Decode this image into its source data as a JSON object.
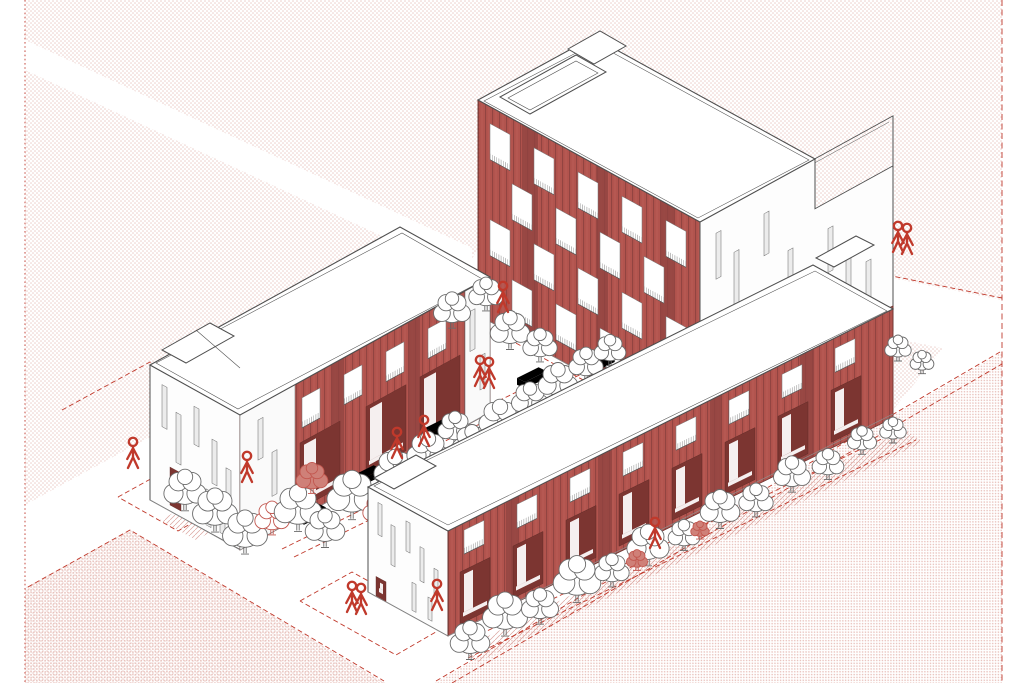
{
  "scene": {
    "kind": "architectural axonometric illustration",
    "subject": "three residential blocks with red facades around a linear tree-lined courtyard",
    "ground": "pink halftone dot fields with white diagonal streets and red dashed parcel lines"
  },
  "colors": {
    "facade": "#b2544e",
    "facade_dark": "#8f4340",
    "facade_shadow": "#7c3531",
    "line": "#4f4f4f",
    "red": "#c0392b",
    "red_soft": "#cf6a61",
    "dot": "#e9c9c4",
    "dot2": "#e6bcb6",
    "tree_line": "#6b6b6b",
    "tree_red": "#c2574f",
    "tree_fill": "#cf8078"
  },
  "buildings": [
    {
      "id": "tower",
      "name": "rear-tower-block",
      "stories": 4,
      "red_faces": 1
    },
    {
      "id": "left-bar",
      "name": "left-low-bar",
      "stories": 3,
      "red_faces": 1
    },
    {
      "id": "front-bar",
      "name": "front-long-bar",
      "stories": 2,
      "red_faces": 1
    }
  ],
  "faces": [
    {
      "target": "w-a-sw",
      "items": [
        {
          "x": 44,
          "y": -215,
          "w": 16,
          "h": 215,
          "k": "panel"
        },
        {
          "x": 118,
          "y": -215,
          "w": 12,
          "h": 215,
          "k": "panel"
        },
        {
          "x": 182,
          "y": -215,
          "w": 14,
          "h": 215,
          "k": "panel"
        },
        {
          "x": 12,
          "y": -198,
          "w": 20,
          "h": 36
        },
        {
          "x": 56,
          "y": -198,
          "w": 20,
          "h": 36
        },
        {
          "x": 100,
          "y": -198,
          "w": 20,
          "h": 36
        },
        {
          "x": 144,
          "y": -198,
          "w": 20,
          "h": 36
        },
        {
          "x": 188,
          "y": -198,
          "w": 20,
          "h": 36
        },
        {
          "x": 34,
          "y": -150,
          "w": 20,
          "h": 36
        },
        {
          "x": 78,
          "y": -150,
          "w": 20,
          "h": 36
        },
        {
          "x": 122,
          "y": -150,
          "w": 20,
          "h": 36
        },
        {
          "x": 166,
          "y": -150,
          "w": 20,
          "h": 36
        },
        {
          "x": 12,
          "y": -102,
          "w": 20,
          "h": 36
        },
        {
          "x": 56,
          "y": -102,
          "w": 20,
          "h": 36
        },
        {
          "x": 100,
          "y": -102,
          "w": 20,
          "h": 36
        },
        {
          "x": 144,
          "y": -102,
          "w": 20,
          "h": 36
        },
        {
          "x": 188,
          "y": -102,
          "w": 20,
          "h": 36
        },
        {
          "x": 34,
          "y": -54,
          "w": 20,
          "h": 36
        },
        {
          "x": 78,
          "y": -54,
          "w": 20,
          "h": 36
        },
        {
          "x": 122,
          "y": -54,
          "w": 20,
          "h": 36
        },
        {
          "x": 166,
          "y": -54,
          "w": 20,
          "h": 36
        }
      ]
    },
    {
      "target": "w-a-se",
      "items": [
        {
          "x": 16,
          "y": -195,
          "w": 5,
          "h": 46,
          "k": "slit"
        },
        {
          "x": 34,
          "y": -166,
          "w": 5,
          "h": 56,
          "k": "slit"
        },
        {
          "x": 64,
          "y": -188,
          "w": 5,
          "h": 42,
          "k": "slit"
        },
        {
          "x": 88,
          "y": -138,
          "w": 5,
          "h": 52,
          "k": "slit"
        },
        {
          "x": 26,
          "y": -94,
          "w": 5,
          "h": 44,
          "k": "slit"
        },
        {
          "x": 56,
          "y": -100,
          "w": 5,
          "h": 54,
          "k": "slit"
        },
        {
          "x": 84,
          "y": -66,
          "w": 5,
          "h": 36,
          "k": "slit"
        },
        {
          "x": 44,
          "y": -54,
          "w": 10,
          "h": 46,
          "k": "dark"
        },
        {
          "x": 128,
          "y": -138,
          "w": 5,
          "h": 44,
          "k": "slit"
        },
        {
          "x": 146,
          "y": -112,
          "w": 5,
          "h": 48,
          "k": "slit"
        },
        {
          "x": 166,
          "y": -84,
          "w": 5,
          "h": 40,
          "k": "slit"
        }
      ]
    },
    {
      "target": "w-b-sw",
      "items": [
        {
          "x": 12,
          "y": -122,
          "w": 5,
          "h": 42,
          "k": "slit"
        },
        {
          "x": 26,
          "y": -102,
          "w": 5,
          "h": 50,
          "k": "slit"
        },
        {
          "x": 44,
          "y": -118,
          "w": 5,
          "h": 38,
          "k": "slit"
        },
        {
          "x": 62,
          "y": -95,
          "w": 5,
          "h": 44,
          "k": "slit"
        },
        {
          "x": 76,
          "y": -74,
          "w": 5,
          "h": 32,
          "k": "slit"
        },
        {
          "x": 20,
          "y": -44,
          "w": 11,
          "h": 38,
          "k": "dark"
        },
        {
          "x": 56,
          "y": -42,
          "w": 5,
          "h": 36,
          "k": "slit"
        },
        {
          "x": 70,
          "y": -36,
          "w": 5,
          "h": 30,
          "k": "slit"
        }
      ]
    },
    {
      "target": "w-b-se",
      "items": [
        {
          "x": 0,
          "y": -135,
          "w": 55,
          "h": 135,
          "k": "bay"
        },
        {
          "x": 225,
          "y": -135,
          "w": 25,
          "h": 135,
          "k": "bay"
        },
        {
          "x": 18,
          "y": -120,
          "w": 5,
          "h": 40,
          "k": "slit"
        },
        {
          "x": 32,
          "y": -80,
          "w": 5,
          "h": 44,
          "k": "slit"
        },
        {
          "x": 230,
          "y": -112,
          "w": 5,
          "h": 40,
          "k": "slit"
        },
        {
          "x": 240,
          "y": -62,
          "w": 5,
          "h": 34,
          "k": "slit"
        },
        {
          "x": 92,
          "y": -135,
          "w": 12,
          "h": 135,
          "k": "panel"
        },
        {
          "x": 168,
          "y": -135,
          "w": 12,
          "h": 135,
          "k": "panel"
        },
        {
          "x": 62,
          "y": -118,
          "w": 18,
          "h": 30
        },
        {
          "x": 104,
          "y": -118,
          "w": 18,
          "h": 30
        },
        {
          "x": 146,
          "y": -118,
          "w": 18,
          "h": 30
        },
        {
          "x": 188,
          "y": -118,
          "w": 18,
          "h": 30
        },
        {
          "x": 60,
          "y": -74,
          "w": 40,
          "h": 66,
          "k": "dark"
        },
        {
          "x": 126,
          "y": -74,
          "w": 40,
          "h": 66,
          "k": "dark"
        },
        {
          "x": 180,
          "y": -74,
          "w": 40,
          "h": 66,
          "k": "dark"
        }
      ]
    },
    {
      "target": "w-c-sw",
      "items": [
        {
          "x": 10,
          "y": -95,
          "w": 4,
          "h": 32,
          "k": "slit"
        },
        {
          "x": 23,
          "y": -80,
          "w": 4,
          "h": 40,
          "k": "slit"
        },
        {
          "x": 38,
          "y": -92,
          "w": 4,
          "h": 30,
          "k": "slit"
        },
        {
          "x": 52,
          "y": -74,
          "w": 4,
          "h": 34,
          "k": "slit"
        },
        {
          "x": 66,
          "y": -60,
          "w": 4,
          "h": 26,
          "k": "slit"
        },
        {
          "x": 8,
          "y": -20,
          "w": 10,
          "h": 20,
          "k": "dark"
        },
        {
          "x": 44,
          "y": -34,
          "w": 4,
          "h": 28,
          "k": "slit"
        },
        {
          "x": 60,
          "y": -28,
          "w": 4,
          "h": 22,
          "k": "slit"
        }
      ]
    },
    {
      "target": "w-c-se",
      "items": [
        {
          "x": 58,
          "y": -112,
          "w": 12,
          "h": 112,
          "k": "panel"
        },
        {
          "x": 150,
          "y": -112,
          "w": 14,
          "h": 112,
          "k": "panel"
        },
        {
          "x": 262,
          "y": -112,
          "w": 12,
          "h": 112,
          "k": "panel"
        },
        {
          "x": 352,
          "y": -112,
          "w": 14,
          "h": 112,
          "k": "panel"
        },
        {
          "x": 16,
          "y": -98,
          "w": 20,
          "h": 24
        },
        {
          "x": 69,
          "y": -98,
          "w": 20,
          "h": 24
        },
        {
          "x": 122,
          "y": -98,
          "w": 20,
          "h": 24
        },
        {
          "x": 175,
          "y": -98,
          "w": 20,
          "h": 24
        },
        {
          "x": 228,
          "y": -98,
          "w": 20,
          "h": 24
        },
        {
          "x": 281,
          "y": -98,
          "w": 20,
          "h": 24
        },
        {
          "x": 334,
          "y": -98,
          "w": 20,
          "h": 24
        },
        {
          "x": 387,
          "y": -98,
          "w": 20,
          "h": 24
        },
        {
          "x": 12,
          "y": -58,
          "w": 30,
          "h": 52,
          "k": "dark"
        },
        {
          "x": 65,
          "y": -58,
          "w": 30,
          "h": 52,
          "k": "dark"
        },
        {
          "x": 118,
          "y": -58,
          "w": 30,
          "h": 52,
          "k": "dark"
        },
        {
          "x": 171,
          "y": -58,
          "w": 30,
          "h": 52,
          "k": "dark"
        },
        {
          "x": 224,
          "y": -58,
          "w": 30,
          "h": 52,
          "k": "dark"
        },
        {
          "x": 277,
          "y": -58,
          "w": 30,
          "h": 52,
          "k": "dark"
        },
        {
          "x": 330,
          "y": -58,
          "w": 30,
          "h": 52,
          "k": "dark"
        },
        {
          "x": 383,
          "y": -58,
          "w": 30,
          "h": 52,
          "k": "dark"
        }
      ]
    }
  ],
  "landscape": {
    "trees_back": [
      [
        185,
        490,
        16,
        "g"
      ],
      [
        215,
        510,
        17,
        "g"
      ],
      [
        245,
        532,
        17,
        "g"
      ],
      [
        272,
        518,
        13,
        "r"
      ],
      [
        298,
        508,
        18,
        "g"
      ],
      [
        312,
        478,
        12,
        "f"
      ],
      [
        325,
        528,
        15,
        "g"
      ],
      [
        352,
        495,
        19,
        "g"
      ],
      [
        380,
        510,
        13,
        "r"
      ],
      [
        395,
        470,
        16,
        "g"
      ],
      [
        412,
        488,
        12,
        "g"
      ],
      [
        428,
        452,
        16,
        "g"
      ],
      [
        448,
        468,
        11,
        "f"
      ],
      [
        455,
        428,
        13,
        "g"
      ],
      [
        472,
        444,
        15,
        "g"
      ],
      [
        500,
        420,
        16,
        "g"
      ],
      [
        530,
        400,
        14,
        "g"
      ],
      [
        558,
        382,
        15,
        "g"
      ],
      [
        586,
        364,
        13,
        "g"
      ],
      [
        610,
        350,
        12,
        "g"
      ],
      [
        452,
        310,
        14,
        "g"
      ],
      [
        486,
        294,
        13,
        "g"
      ],
      [
        510,
        330,
        15,
        "g"
      ],
      [
        540,
        345,
        13,
        "g"
      ]
    ],
    "trees_front": [
      [
        470,
        640,
        15,
        "g"
      ],
      [
        505,
        614,
        17,
        "g"
      ],
      [
        540,
        606,
        14,
        "g"
      ],
      [
        577,
        579,
        18,
        "g"
      ],
      [
        612,
        570,
        13,
        "g"
      ],
      [
        648,
        545,
        16,
        "g"
      ],
      [
        684,
        535,
        12,
        "g"
      ],
      [
        720,
        509,
        15,
        "g"
      ],
      [
        756,
        500,
        13,
        "g"
      ],
      [
        792,
        474,
        14,
        "g"
      ],
      [
        828,
        464,
        12,
        "g"
      ],
      [
        862,
        440,
        11,
        "g"
      ],
      [
        893,
        430,
        10,
        "g"
      ],
      [
        898,
        348,
        10,
        "g"
      ],
      [
        922,
        362,
        9,
        "g"
      ],
      [
        637,
        560,
        8,
        "f"
      ],
      [
        700,
        530,
        7,
        "f"
      ]
    ],
    "benches": [
      [
        296,
        514
      ],
      [
        352,
        476
      ],
      [
        425,
        428
      ],
      [
        517,
        378
      ],
      [
        585,
        362
      ]
    ],
    "people_back": [
      {
        "x": 247,
        "y": 482,
        "n": 1
      },
      {
        "x": 397,
        "y": 458,
        "n": 1
      },
      {
        "x": 503,
        "y": 312,
        "n": 1
      },
      {
        "x": 480,
        "y": 386,
        "n": 2
      },
      {
        "x": 424,
        "y": 446,
        "n": 1
      }
    ],
    "people_front": [
      {
        "x": 133,
        "y": 468,
        "n": 1
      },
      {
        "x": 352,
        "y": 612,
        "n": 2
      },
      {
        "x": 437,
        "y": 610,
        "n": 1
      },
      {
        "x": 898,
        "y": 252,
        "n": 2
      },
      {
        "x": 655,
        "y": 548,
        "n": 1
      }
    ],
    "dashed_paths": [
      [
        [
          240,
          528
        ],
        [
          606,
          348
        ]
      ],
      [
        [
          252,
          536
        ],
        [
          618,
          356
        ]
      ],
      [
        [
          282,
          549
        ],
        [
          630,
          378
        ]
      ],
      [
        [
          294,
          557
        ],
        [
          642,
          386
        ]
      ],
      [
        [
          452,
          256
        ],
        [
          578,
          326
        ]
      ],
      [
        [
          438,
          266
        ],
        [
          564,
          336
        ]
      ],
      [
        [
          62,
          410
        ],
        [
          150,
          362
        ],
        [
          208,
          393
        ]
      ],
      [
        [
          118,
          497
        ],
        [
          156,
          476
        ],
        [
          216,
          509
        ],
        [
          178,
          531
        ],
        [
          118,
          497
        ]
      ],
      [
        [
          300,
          601
        ],
        [
          352,
          572
        ],
        [
          448,
          625
        ],
        [
          396,
          655
        ],
        [
          300,
          601
        ]
      ],
      [
        [
          28,
          587
        ],
        [
          130,
          530
        ],
        [
          384,
          681
        ]
      ],
      [
        [
          452,
          648
        ],
        [
          900,
          430
        ]
      ],
      [
        [
          468,
          658
        ],
        [
          916,
          440
        ]
      ],
      [
        [
          762,
          250
        ],
        [
          1002,
          298
        ]
      ],
      [
        [
          436,
          681
        ],
        [
          1000,
          352
        ]
      ],
      [
        [
          452,
          683
        ],
        [
          1002,
          364
        ]
      ],
      [
        [
          474,
          320
        ],
        [
          696,
          442
        ]
      ]
    ],
    "hatch_strips": [
      [
        [
          460,
          650
        ],
        [
          905,
          430
        ],
        [
          923,
          442
        ],
        [
          478,
          662
        ]
      ],
      [
        [
          160,
          520
        ],
        [
          250,
          472
        ],
        [
          286,
          492
        ],
        [
          196,
          540
        ]
      ]
    ]
  }
}
